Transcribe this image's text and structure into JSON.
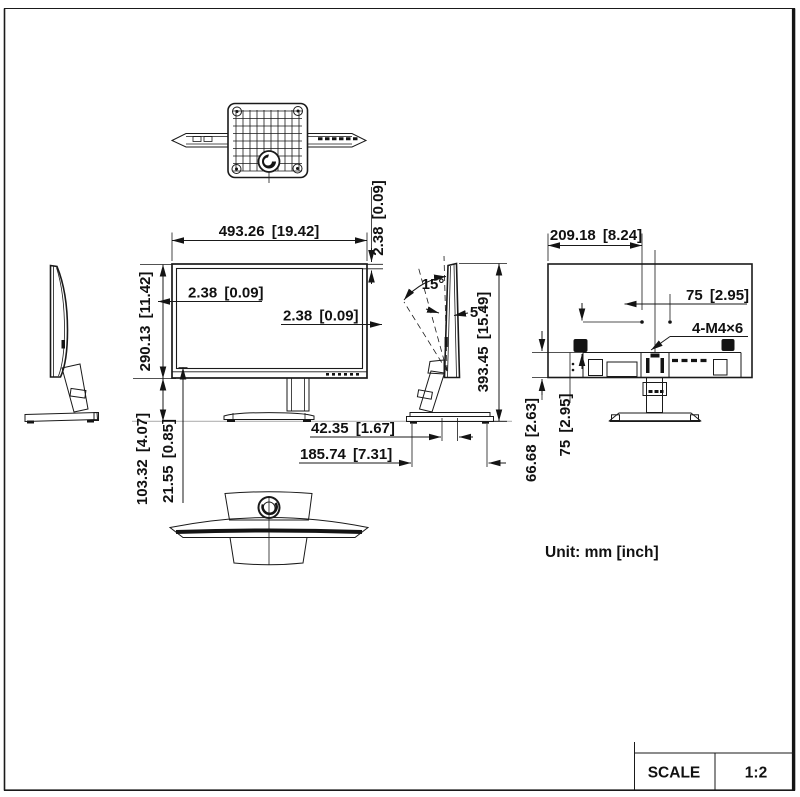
{
  "page": {
    "unit_note": "Unit: mm [inch]",
    "title_block": {
      "scale_label": "SCALE",
      "scale_value": "1:2"
    }
  },
  "dims": {
    "front_width": "493.26 [19.42]",
    "bezel_top": "2.38 [0.09]",
    "bezel_left": "2.38 [0.09]",
    "bezel_right": "2.38 [0.09]",
    "screen_height": "290.13 [11.42]",
    "stand_height": "103.32 [4.07]",
    "panel_bottom_offset": "21.55 [0.85]",
    "total_height": "393.45 [15.49]",
    "pivot_depth": "42.35 [1.67]",
    "base_depth": "185.74 [7.31]",
    "rear_width": "209.18 [8.24]",
    "vesa_horizontal": "75 [2.95]",
    "vesa_vertical": "75 [2.95]",
    "vesa_bottom_offset": "66.68 [2.63]",
    "screw_spec": "4-M4×6"
  },
  "angles": {
    "tilt_back": "15°",
    "tilt_forward": "5°"
  }
}
